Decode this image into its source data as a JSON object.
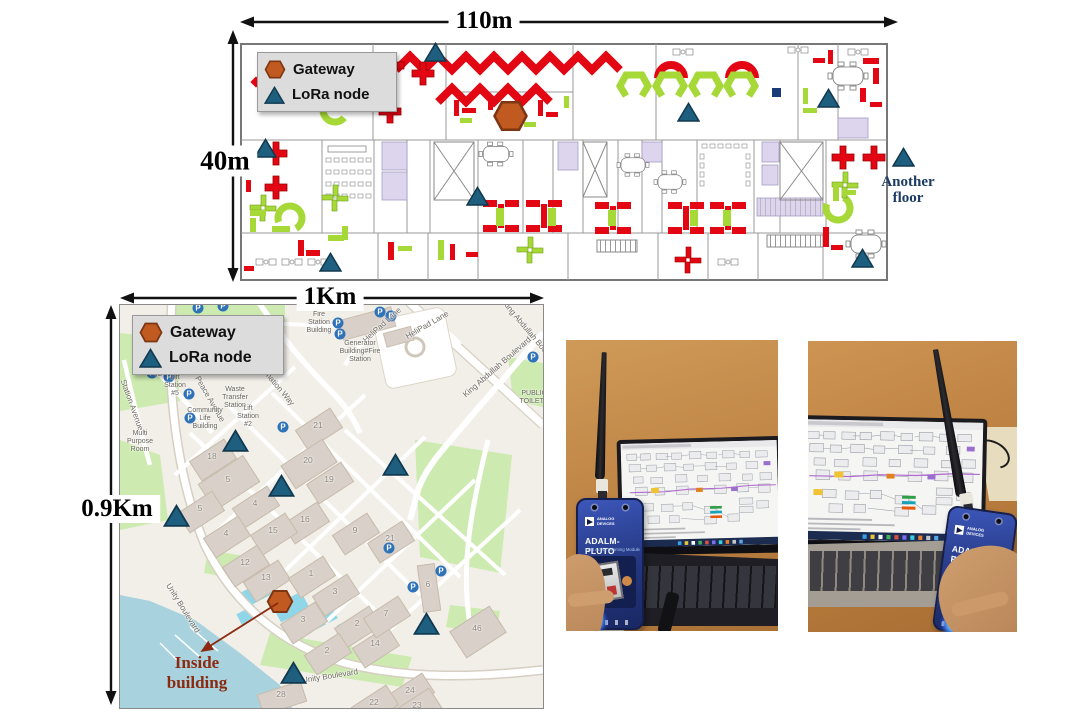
{
  "colors": {
    "node": "#1e5f80",
    "node_stroke": "#10384f",
    "gateway": "#c05a20",
    "gateway_stroke": "#7d3611",
    "furniture_red": "#e30613",
    "furniture_green": "#a6d838",
    "map_water": "#a8d2de",
    "map_green": "#cdebb0",
    "map_building": "#d9d0c9",
    "annotation_red": "#8b2a10",
    "annotation_navy": "#1c3c63"
  },
  "floorplan": {
    "width_label": "110m",
    "height_label": "40m",
    "legend": {
      "gateway": "Gateway",
      "lora": "LoRa node"
    },
    "another_floor": "Another\nfloor",
    "gateway": {
      "x": 272,
      "y": 86
    },
    "nodes": [
      [
        197,
        22
      ],
      [
        27,
        118
      ],
      [
        239,
        166
      ],
      [
        92,
        232
      ],
      [
        450,
        82
      ],
      [
        590,
        68
      ],
      [
        624,
        228
      ],
      [
        665,
        127
      ]
    ]
  },
  "map": {
    "width_label": "1Km",
    "height_label": "0.9Km",
    "legend": {
      "gateway": "Gateway",
      "lora": "LoRa node"
    },
    "inside_building": "Inside\nbuilding",
    "parking_label": "P",
    "gateway": {
      "x": 160,
      "y": 296
    },
    "nodes": [
      [
        115,
        135
      ],
      [
        161,
        180
      ],
      [
        56,
        210
      ],
      [
        275,
        159
      ],
      [
        306,
        318
      ],
      [
        173,
        367
      ]
    ],
    "streets": [
      {
        "t": "Unity Boulevard",
        "x": 63,
        "y": 303,
        "r": 58
      },
      {
        "t": "Unity Boulevard",
        "x": 210,
        "y": 371,
        "r": -9
      },
      {
        "t": "King Abdullah Boulevard",
        "x": 377,
        "y": 62,
        "r": -41
      },
      {
        "t": "King Abdullah Boulevard",
        "x": 412,
        "y": 30,
        "r": 50
      },
      {
        "t": "Transformation Way",
        "x": 150,
        "y": 72,
        "r": 50
      },
      {
        "t": "HeliPad Lane",
        "x": 262,
        "y": 20,
        "r": -42
      },
      {
        "t": "HeliPad Lane",
        "x": 307,
        "y": 20,
        "r": -30
      },
      {
        "t": "Peace Avenue",
        "x": 90,
        "y": 94,
        "r": 60
      },
      {
        "t": "Station Avenue",
        "x": 12,
        "y": 100,
        "r": 70
      }
    ],
    "pois": [
      {
        "t": "Fire Station\nBuilding",
        "x": 199,
        "y": 18
      },
      {
        "t": "Generator\nBuilding#Fire\nStation",
        "x": 240,
        "y": 47
      },
      {
        "t": "Storm Lift\nStation #2",
        "x": 38,
        "y": 58
      },
      {
        "t": "Sanitary Lift\nStation #5",
        "x": 55,
        "y": 77
      },
      {
        "t": "Waste\nTransfer\nStation",
        "x": 115,
        "y": 93
      },
      {
        "t": "Facility",
        "x": 113,
        "y": 64
      },
      {
        "t": "Community\nLife Building",
        "x": 85,
        "y": 114
      },
      {
        "t": "Multi\nPurpose\nRoom",
        "x": 20,
        "y": 137
      },
      {
        "t": "Lift\nStation #2",
        "x": 128,
        "y": 112
      },
      {
        "t": "PUBLIC\nTOILETS",
        "x": 414,
        "y": 93
      }
    ],
    "buildings": [
      {
        "n": "18",
        "x": 92,
        "y": 151
      },
      {
        "n": "5",
        "x": 108,
        "y": 174,
        "w": 52,
        "h": 30
      },
      {
        "n": "5",
        "x": 80,
        "y": 203
      },
      {
        "n": "21",
        "x": 198,
        "y": 120
      },
      {
        "n": "20",
        "x": 188,
        "y": 155,
        "w": 48,
        "h": 26
      },
      {
        "n": "19",
        "x": 209,
        "y": 174
      },
      {
        "n": "4",
        "x": 135,
        "y": 198
      },
      {
        "n": "4",
        "x": 106,
        "y": 228
      },
      {
        "n": "16",
        "x": 185,
        "y": 214
      },
      {
        "n": "15",
        "x": 153,
        "y": 225
      },
      {
        "n": "9",
        "x": 235,
        "y": 225
      },
      {
        "n": "21",
        "x": 270,
        "y": 233
      },
      {
        "n": "12",
        "x": 125,
        "y": 257
      },
      {
        "n": "13",
        "x": 146,
        "y": 272
      },
      {
        "n": "1",
        "x": 191,
        "y": 268
      },
      {
        "n": "3",
        "x": 215,
        "y": 286
      },
      {
        "n": "3",
        "x": 183,
        "y": 314
      },
      {
        "n": "2",
        "x": 237,
        "y": 318
      },
      {
        "n": "2",
        "x": 207,
        "y": 345
      },
      {
        "n": "14",
        "x": 255,
        "y": 338
      },
      {
        "n": "7",
        "x": 266,
        "y": 308
      },
      {
        "n": "6",
        "x": 308,
        "y": 279,
        "w": 16,
        "h": 46,
        "r": -8
      },
      {
        "n": "46",
        "x": 357,
        "y": 323,
        "w": 46,
        "h": 30
      },
      {
        "n": "24",
        "x": 290,
        "y": 385
      },
      {
        "n": "23",
        "x": 297,
        "y": 400
      },
      {
        "n": "28",
        "x": 161,
        "y": 389,
        "w": 44,
        "h": 20,
        "r": -18
      },
      {
        "n": "22",
        "x": 254,
        "y": 397
      }
    ],
    "parking": [
      [
        78,
        3
      ],
      [
        103,
        1
      ],
      [
        218,
        18
      ],
      [
        220,
        29
      ],
      [
        260,
        7
      ],
      [
        271,
        11
      ],
      [
        32,
        68
      ],
      [
        49,
        72
      ],
      [
        69,
        89
      ],
      [
        70,
        113
      ],
      [
        163,
        122
      ],
      [
        269,
        243
      ],
      [
        321,
        266
      ],
      [
        293,
        282
      ],
      [
        413,
        52
      ]
    ]
  },
  "photos": [
    {
      "brand": "ANALOG DEVICES",
      "device_title": "ADALM-PLUTO",
      "device_subtitle": "SDR Active Learning Module"
    },
    {
      "brand": "ANALOG DEVICES",
      "device_title": "ADALM-PLUTO",
      "device_subtitle": "SDR Active Learning Module"
    }
  ]
}
